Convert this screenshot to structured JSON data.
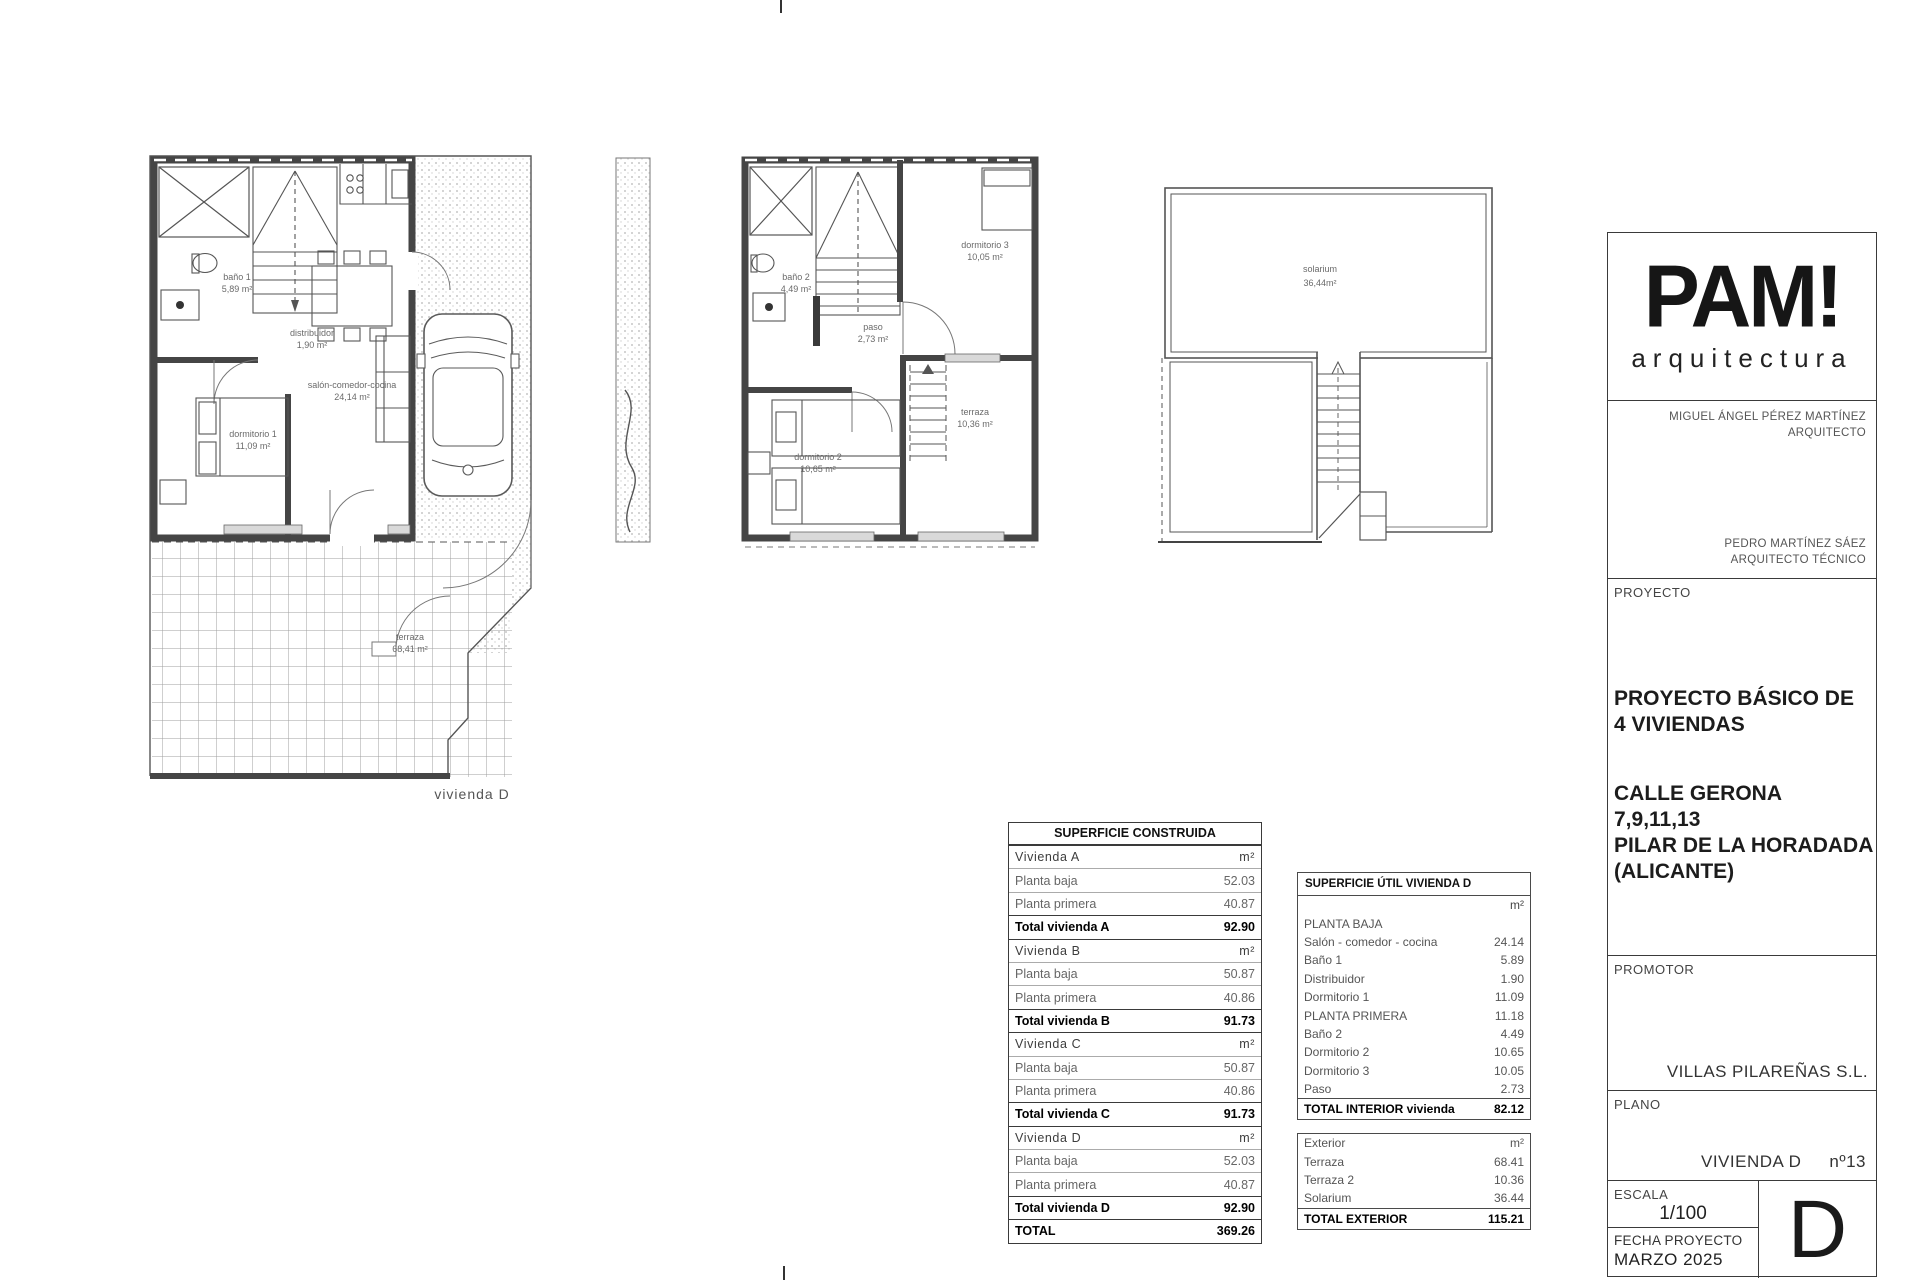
{
  "plans": {
    "ground_floor": {
      "label": "vivienda D",
      "rooms": [
        {
          "name": "baño 1",
          "area": "5,89 m²"
        },
        {
          "name": "distribuidor",
          "area": "1,90 m²"
        },
        {
          "name": "salón-comedor-cocina",
          "area": "24,14 m²"
        },
        {
          "name": "dormitorio 1",
          "area": "11,09 m²"
        },
        {
          "name": "terraza",
          "area": "68,41 m²"
        }
      ]
    },
    "first_floor": {
      "rooms": [
        {
          "name": "baño 2",
          "area": "4,49 m²"
        },
        {
          "name": "paso",
          "area": "2,73 m²"
        },
        {
          "name": "dormitorio 3",
          "area": "10,05 m²"
        },
        {
          "name": "dormitorio 2",
          "area": "10,65 m²"
        },
        {
          "name": "terraza",
          "area": "10,36 m²"
        }
      ]
    },
    "roof": {
      "rooms": [
        {
          "name": "solarium",
          "area": "36,44m²"
        }
      ]
    }
  },
  "tables": {
    "construida": {
      "title": "SUPERFICIE CONSTRUIDA",
      "rows": [
        {
          "label": "Vivienda A",
          "value": "m²"
        },
        {
          "label": "Planta baja",
          "value": "52.03"
        },
        {
          "label": "Planta primera",
          "value": "40.87"
        },
        {
          "label": "Total vivienda A",
          "value": "92.90"
        },
        {
          "label": "Vivienda B",
          "value": "m²"
        },
        {
          "label": "Planta baja",
          "value": "50.87"
        },
        {
          "label": "Planta primera",
          "value": "40.86"
        },
        {
          "label": "Total vivienda B",
          "value": "91.73"
        },
        {
          "label": "Vivienda C",
          "value": "m²"
        },
        {
          "label": "Planta baja",
          "value": "50.87"
        },
        {
          "label": "Planta primera",
          "value": "40.86"
        },
        {
          "label": "Total vivienda C",
          "value": "91.73"
        },
        {
          "label": "Vivienda D",
          "value": "m²"
        },
        {
          "label": "Planta baja",
          "value": "52.03"
        },
        {
          "label": "Planta primera",
          "value": "40.87"
        },
        {
          "label": "Total vivienda D",
          "value": "92.90"
        },
        {
          "label": "TOTAL",
          "value": "369.26"
        }
      ]
    },
    "util": {
      "title": "SUPERFICIE ÚTIL VIVIENDA D",
      "rows": [
        {
          "label": "",
          "value": "m²"
        },
        {
          "label": "PLANTA BAJA",
          "value": ""
        },
        {
          "label": "Salón - comedor - cocina",
          "value": "24.14"
        },
        {
          "label": "Baño 1",
          "value": "5.89"
        },
        {
          "label": "Distribuidor",
          "value": "1.90"
        },
        {
          "label": "Dormitorio 1",
          "value": "11.09"
        },
        {
          "label": "PLANTA PRIMERA",
          "value": "11.18"
        },
        {
          "label": "Baño 2",
          "value": "4.49"
        },
        {
          "label": "Dormitorio 2",
          "value": "10.65"
        },
        {
          "label": "Dormitorio 3",
          "value": "10.05"
        },
        {
          "label": "Paso",
          "value": "2.73"
        },
        {
          "label": "TOTAL INTERIOR vivienda",
          "value": "82.12"
        }
      ],
      "exterior_rows": [
        {
          "label": "Exterior",
          "value": "m²"
        },
        {
          "label": "Terraza",
          "value": "68.41"
        },
        {
          "label": "Terraza 2",
          "value": "10.36"
        },
        {
          "label": "Solarium",
          "value": "36.44"
        },
        {
          "label": "TOTAL EXTERIOR",
          "value": "115.21"
        }
      ]
    }
  },
  "titleblock": {
    "logo": {
      "title": "PAM!",
      "subtitle": "arquitectura"
    },
    "architect1": {
      "name": "MIGUEL ÁNGEL PÉREZ MARTÍNEZ",
      "role": "ARQUITECTO"
    },
    "architect2": {
      "name": "PEDRO MARTÍNEZ SÁEZ",
      "role": "ARQUITECTO TÉCNICO"
    },
    "proyecto": {
      "label": "PROYECTO",
      "title_line1": "PROYECTO BÁSICO DE",
      "title_line2": "4 VIVIENDAS",
      "address_line1": "CALLE GERONA",
      "address_line2": "7,9,11,13",
      "address_line3": "PILAR DE LA HORADADA",
      "address_line4": "(ALICANTE)"
    },
    "promotor": {
      "label": "PROMOTOR",
      "value": "VILLAS PILAREÑAS S.L."
    },
    "plano": {
      "label": "PLANO",
      "name": "VIVIENDA D",
      "number": "nº13"
    },
    "escala": {
      "label": "ESCALA",
      "value": "1/100"
    },
    "fecha": {
      "label": "FECHA PROYECTO",
      "value": "MARZO 2025"
    },
    "sheet_letter": "D"
  }
}
